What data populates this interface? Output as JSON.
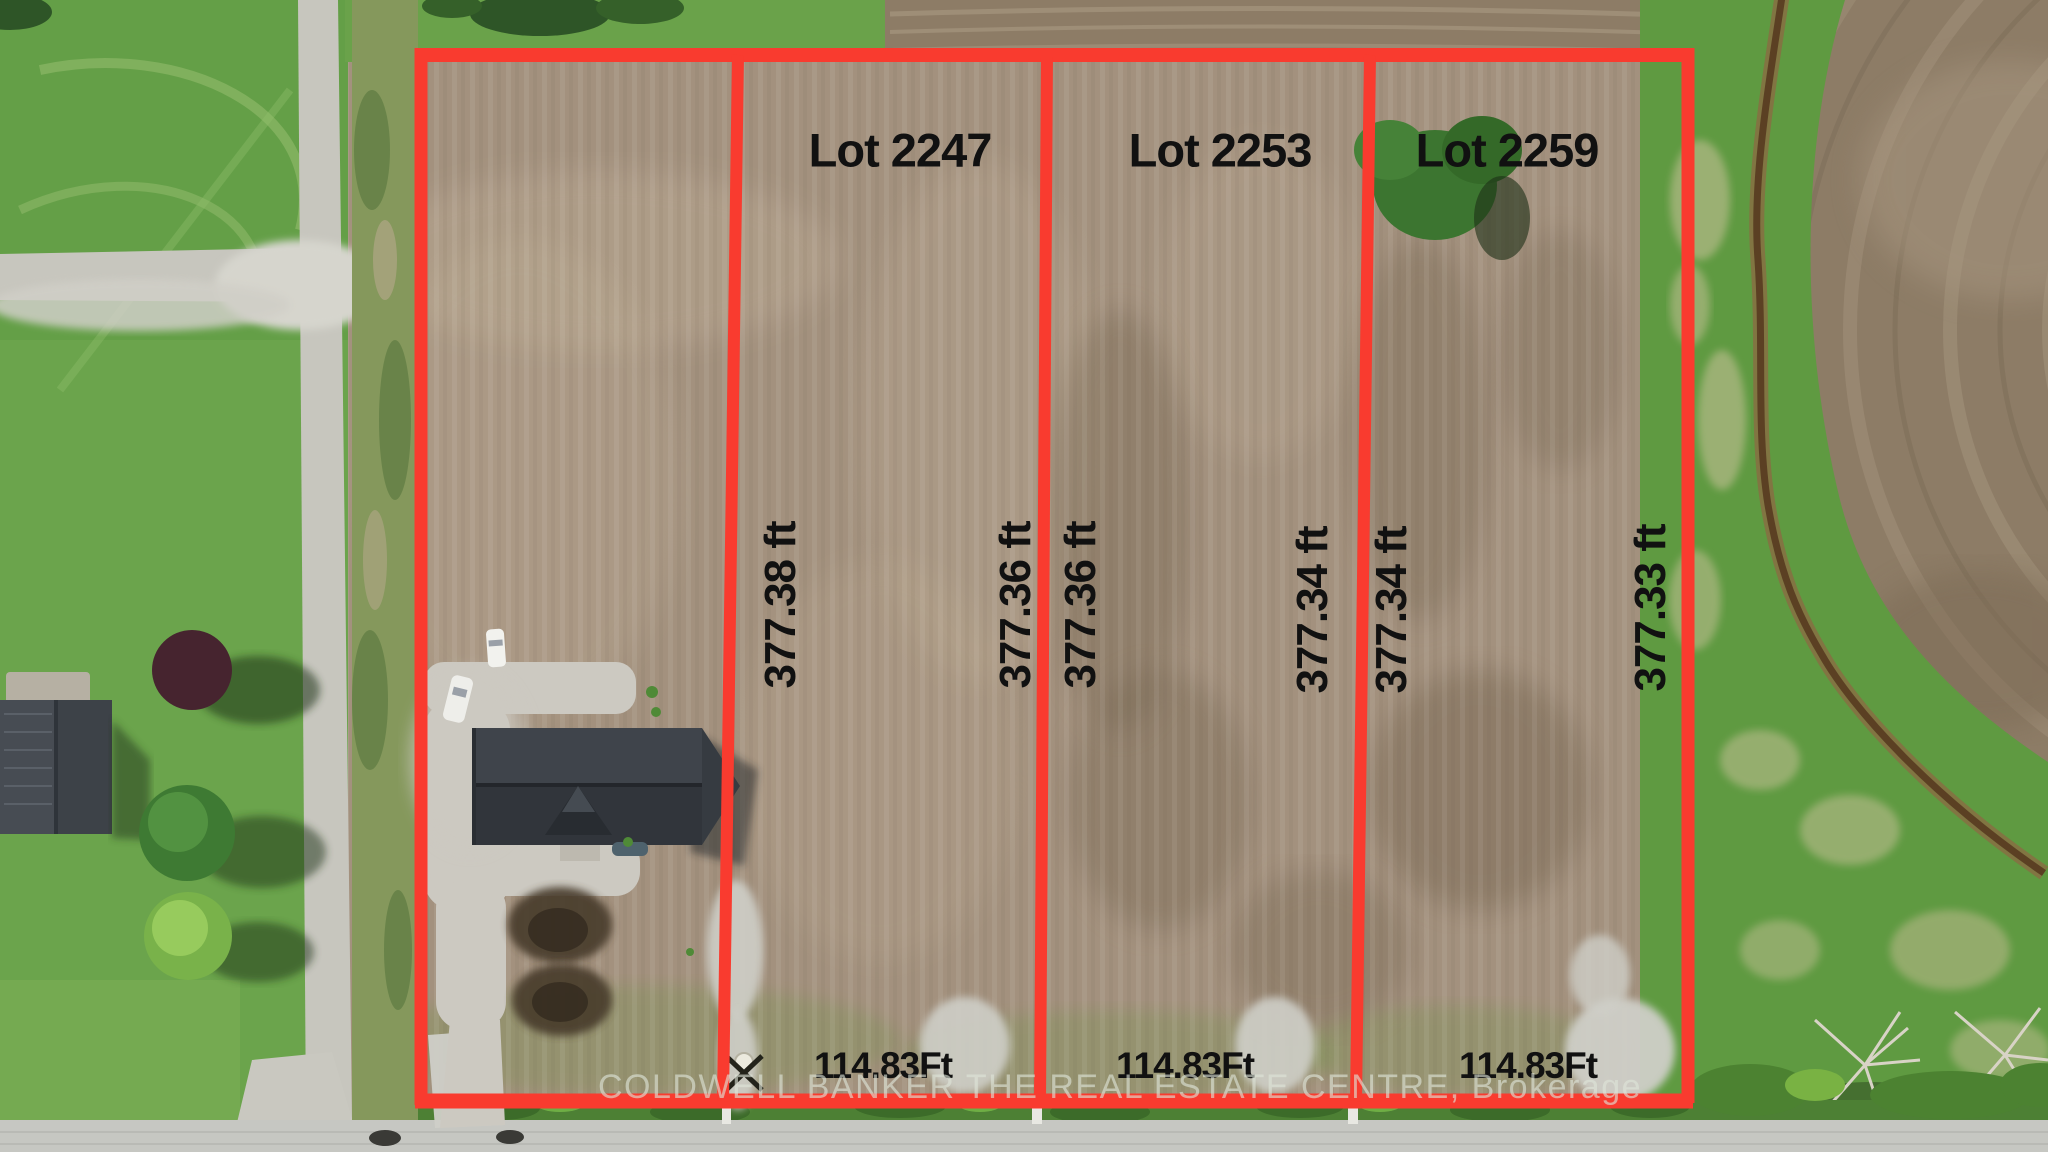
{
  "annotation": {
    "lots": [
      {
        "label": "Lot 2247",
        "west_dimension": "377.38 ft",
        "east_dimension": "377.36 ft",
        "frontage": "114.83Ft"
      },
      {
        "label": "Lot 2253",
        "west_dimension": "377.36 ft",
        "east_dimension": "377.34 ft",
        "frontage": "114.83Ft"
      },
      {
        "label": "Lot 2259",
        "west_dimension": "377.34 ft",
        "east_dimension": "377.33 ft",
        "frontage": "114.83Ft"
      }
    ],
    "watermark": "COLDWELL BANKER THE REAL ESTATE CENTRE, Brokerage",
    "colors": {
      "boundary_red": "#f93b2f",
      "dimension_text": "#111111",
      "watermark_text": "#dfe5d9"
    }
  }
}
